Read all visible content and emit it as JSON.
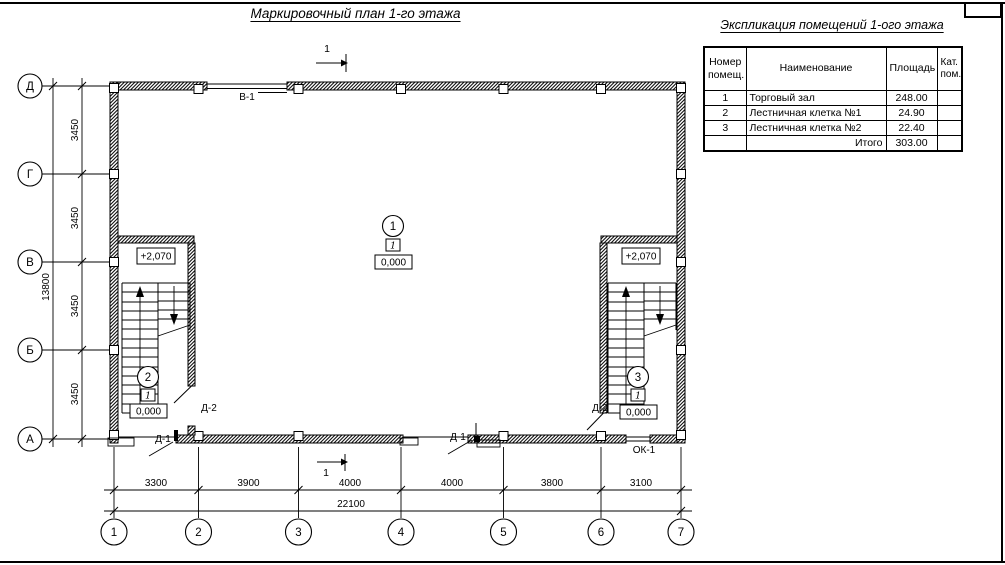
{
  "sheet": {
    "title": "Маркировочный план 1-го этажа"
  },
  "explication": {
    "title": "Экспликация помещений 1-ого этажа",
    "headers": {
      "number": "Номер помещ.",
      "name": "Наименование",
      "area": "Площадь",
      "category": "Кат. пом."
    },
    "rows": [
      {
        "number": "1",
        "name": "Торговый зал",
        "area": "248.00",
        "category": ""
      },
      {
        "number": "2",
        "name": "Лестничная клетка №1",
        "area": "24.90",
        "category": ""
      },
      {
        "number": "3",
        "name": "Лестничная клетка №2",
        "area": "22.40",
        "category": ""
      }
    ],
    "total": {
      "label": "Итого",
      "area": "303.00"
    }
  },
  "plan": {
    "section_mark": "1",
    "row_axes": [
      "Д",
      "Г",
      "В",
      "Б",
      "А"
    ],
    "col_axes": [
      "1",
      "2",
      "3",
      "4",
      "5",
      "6",
      "7"
    ],
    "v_dims": [
      "3450",
      "3450",
      "3450",
      "3450"
    ],
    "v_total": "13800",
    "h_dims": [
      "3300",
      "3900",
      "4000",
      "4000",
      "3800",
      "3100"
    ],
    "h_total": "22100",
    "marks": {
      "window_top": "В-1",
      "window_bottom": "ОК-1",
      "door_exterior": "Д-1",
      "door_interior": "Д-2",
      "level_upper": "+2,070",
      "level_zero": "0,000",
      "type_mark": "1"
    },
    "rooms": [
      "1",
      "2",
      "3"
    ]
  }
}
